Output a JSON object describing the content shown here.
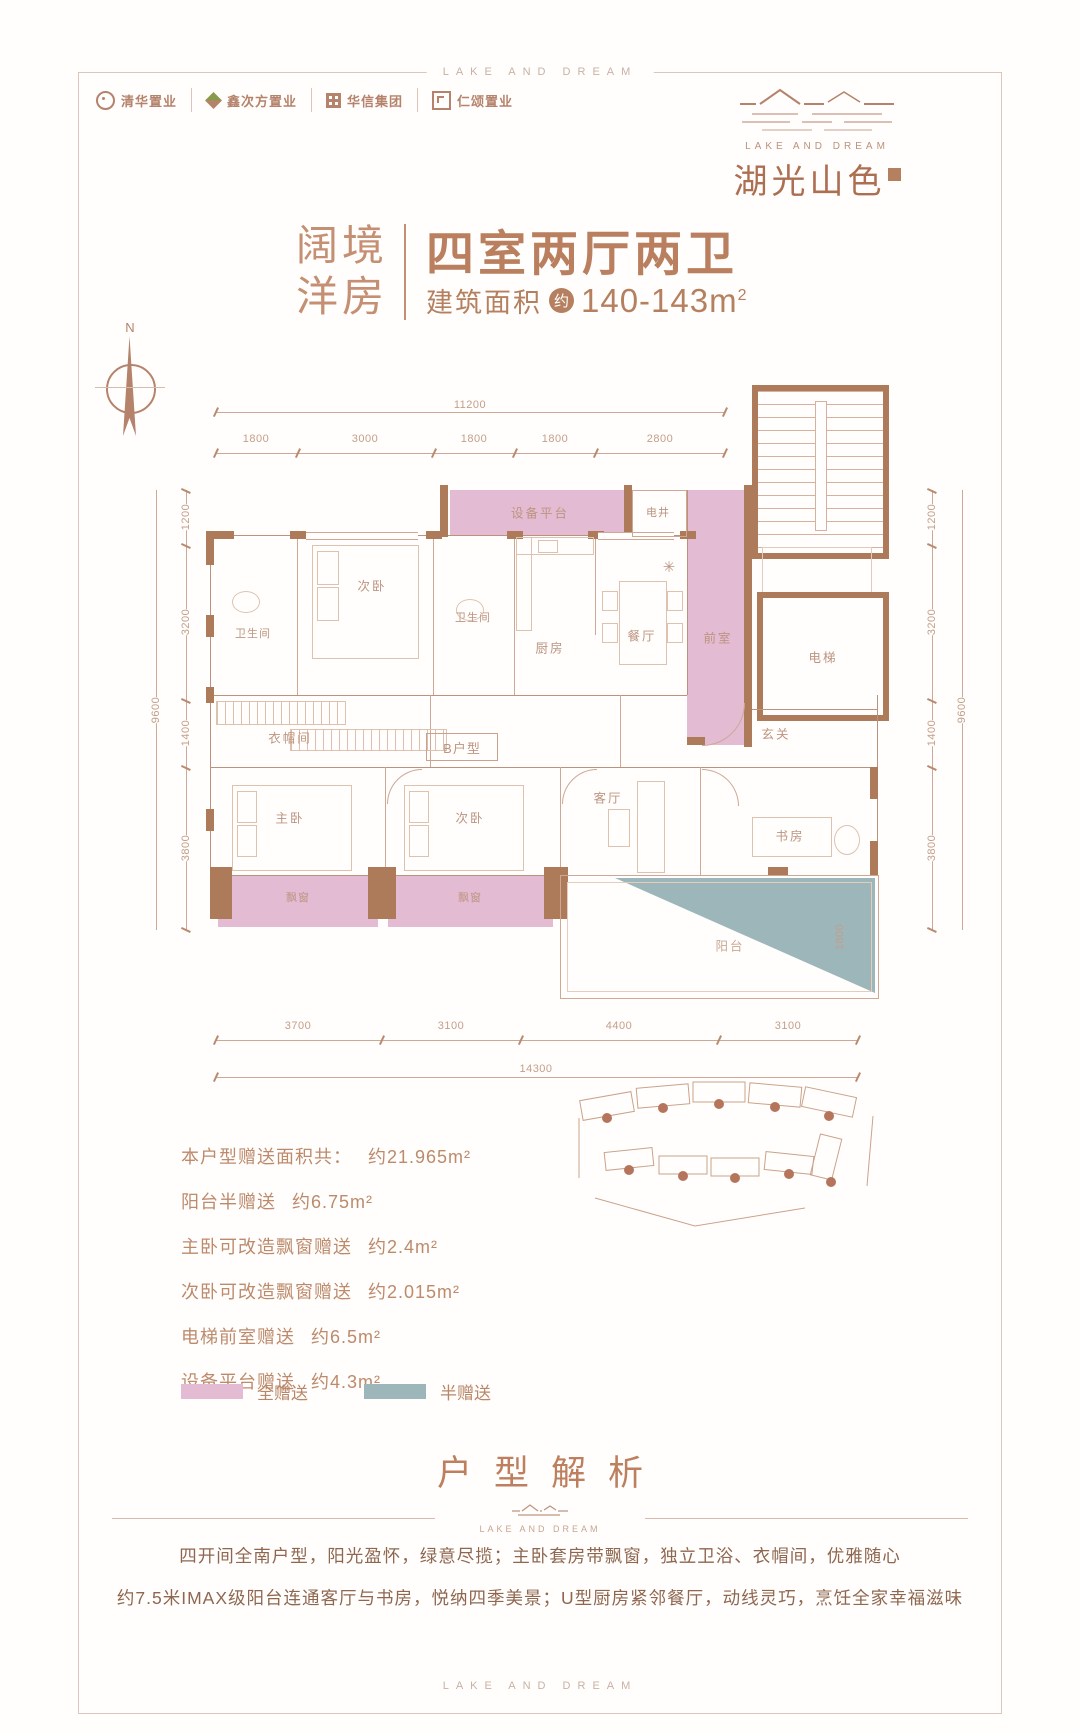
{
  "frame": {
    "brand_top": "LAKE AND DREAM",
    "brand_bottom": "LAKE AND DREAM"
  },
  "header": {
    "partners": [
      "清华置业",
      "鑫次方置业",
      "华信集团",
      "仁颂置业"
    ],
    "brand": {
      "en": "LAKE AND DREAM",
      "cn": "湖光山色"
    }
  },
  "title_block": {
    "tag_line1": "阔境",
    "tag_line2": "洋房",
    "headline": "四室两厅两卫",
    "area_label": "建筑面积",
    "approx_badge": "约",
    "area_value": "140-143m",
    "area_sup": "2"
  },
  "compass": {
    "north": "N"
  },
  "floorplan": {
    "unit_label": "B户型",
    "rooms": {
      "equip": "设备平台",
      "shaft": "电井",
      "front": "前室",
      "elevator": "电梯",
      "bath1": "卫生间",
      "bed_top": "次卧",
      "bath2": "卫生间",
      "kitchen": "厨房",
      "dining": "餐厅",
      "closet": "衣帽间",
      "entry": "玄关",
      "master": "主卧",
      "bed_bottom": "次卧",
      "living": "客厅",
      "study": "书房",
      "bay1": "飘窗",
      "bay2": "飘窗",
      "balcony": "阳台"
    },
    "symbols": {
      "ac": "✳"
    },
    "dims": {
      "top_total": "11200",
      "top_segs": [
        "1800",
        "3000",
        "1800",
        "1800",
        "2800"
      ],
      "left_segs": [
        "1200",
        "3200",
        "1400",
        "3800"
      ],
      "left_total": "9600",
      "right_segs": [
        "1200",
        "3200",
        "1400",
        "3800"
      ],
      "right_total": "9600",
      "bottom_segs": [
        "3700",
        "3100",
        "4400",
        "3100"
      ],
      "bottom_total": "14300",
      "balcony_depth": "1800"
    },
    "colors": {
      "full_gift": "#e3bbd3",
      "half_gift": "#9cb6ba",
      "wall": "#ad7a5a",
      "accent": "#b5826b"
    }
  },
  "gifts": {
    "items": [
      {
        "label": "本户型赠送面积共：",
        "value": "约21.965m²"
      },
      {
        "label": "阳台半赠送",
        "value": "约6.75m²"
      },
      {
        "label": "主卧可改造飘窗赠送",
        "value": "约2.4m²"
      },
      {
        "label": "次卧可改造飘窗赠送",
        "value": "约2.015m²"
      },
      {
        "label": "电梯前室赠送",
        "value": "约6.5m²"
      },
      {
        "label": "设备平台赠送",
        "value": "约4.3m²"
      }
    ],
    "legend": {
      "full": "全赠送",
      "half": "半赠送"
    }
  },
  "analysis": {
    "title": "户型解析",
    "divider_brand": "LAKE AND DREAM",
    "line1": "四开间全南户型，阳光盈怀，绿意尽揽；主卧套房带飘窗，独立卫浴、衣帽间，优雅随心",
    "line2": "约7.5米IMAX级阳台连通客厅与书房，悦纳四季美景；U型厨房紧邻餐厅，动线灵巧，烹饪全家幸福滋味"
  }
}
